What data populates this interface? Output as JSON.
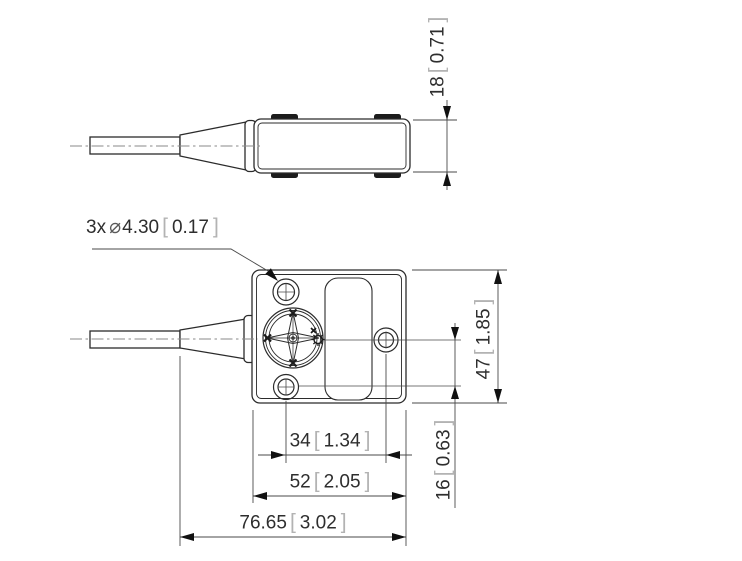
{
  "symbols": {
    "bracket_open": "[",
    "bracket_close": "]"
  },
  "note": {
    "prefix": "3x",
    "diameter_symbol": "⌀",
    "mm": "4.30",
    "inch": "0.17"
  },
  "dimensions": {
    "height_side": {
      "mm": "18",
      "inch": "0.71"
    },
    "height_front": {
      "mm": "47",
      "inch": "1.85"
    },
    "hole_spacing": {
      "mm": "34",
      "inch": "1.34"
    },
    "body_width": {
      "mm": "52",
      "inch": "2.05"
    },
    "total_length": {
      "mm": "76.65",
      "inch": "3.02"
    },
    "hole_offset": {
      "mm": "16",
      "inch": "0.63"
    }
  },
  "colors": {
    "object_line": "#2b2b2b",
    "thin_line": "#4a4a4a",
    "centerline": "#8a8a8a",
    "text": "#2e2e2e",
    "bracket": "#b3b3b3",
    "background": "#ffffff"
  }
}
